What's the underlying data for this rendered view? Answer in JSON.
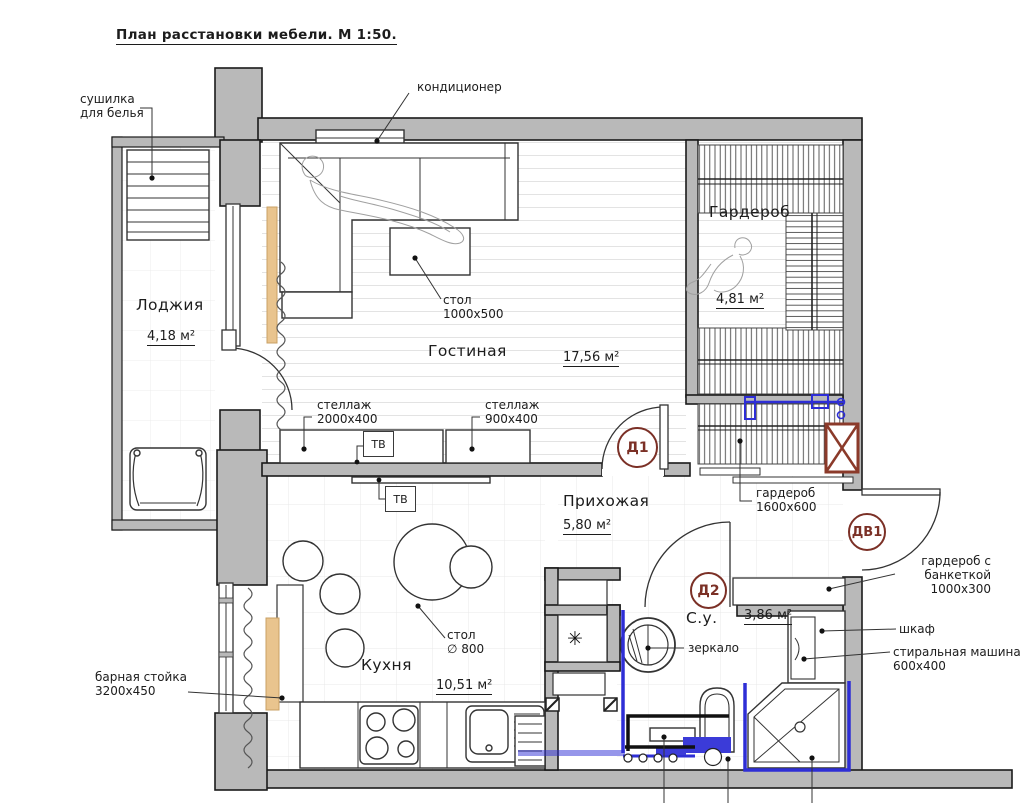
{
  "title": "План расстановки мебели. М 1:50.",
  "colors": {
    "wall_fill": "#b9b9b9",
    "line": "#333333",
    "plumbing_blue": "#2e2ed6",
    "door_tag": "#7b3026",
    "wood_accent": "#e9c48e",
    "vent_red": "#8b3a2a"
  },
  "rooms": {
    "living": {
      "name": "Гостиная",
      "area": "17,56 м²"
    },
    "loggia": {
      "name": "Лоджия",
      "area": "4,18 м²"
    },
    "wardrobe": {
      "name": "Гардероб",
      "area": "4,81 м²"
    },
    "hallway": {
      "name": "Прихожая",
      "area": "5,80 м²"
    },
    "bathroom": {
      "name": "С.у.",
      "area": "3,86 м²"
    },
    "kitchen": {
      "name": "Кухня",
      "area": "10,51 м²"
    }
  },
  "doors": {
    "d1": "Д1",
    "d2": "Д2",
    "dv1": "ДВ1"
  },
  "ann": {
    "dryer": [
      "сушилка",
      "для белья"
    ],
    "ac": "кондиционер",
    "coffee_table": [
      "стол",
      "1000х500"
    ],
    "shelf1": [
      "стеллаж",
      "2000х400"
    ],
    "shelf2": [
      "стеллаж",
      "900х400"
    ],
    "tv": "ТВ",
    "hall_wardrobe": [
      "гардероб",
      "1600х600"
    ],
    "entry_wardrobe": [
      "гардероб с",
      "банкеткой",
      "1000х300"
    ],
    "cabinet": "шкаф",
    "washer": [
      "стиральная машина",
      "600х400"
    ],
    "mirror": "зеркало",
    "bar": [
      "барная стойка",
      "3200х450"
    ],
    "table": [
      "стол",
      "∅ 800"
    ],
    "fan": "✳"
  }
}
